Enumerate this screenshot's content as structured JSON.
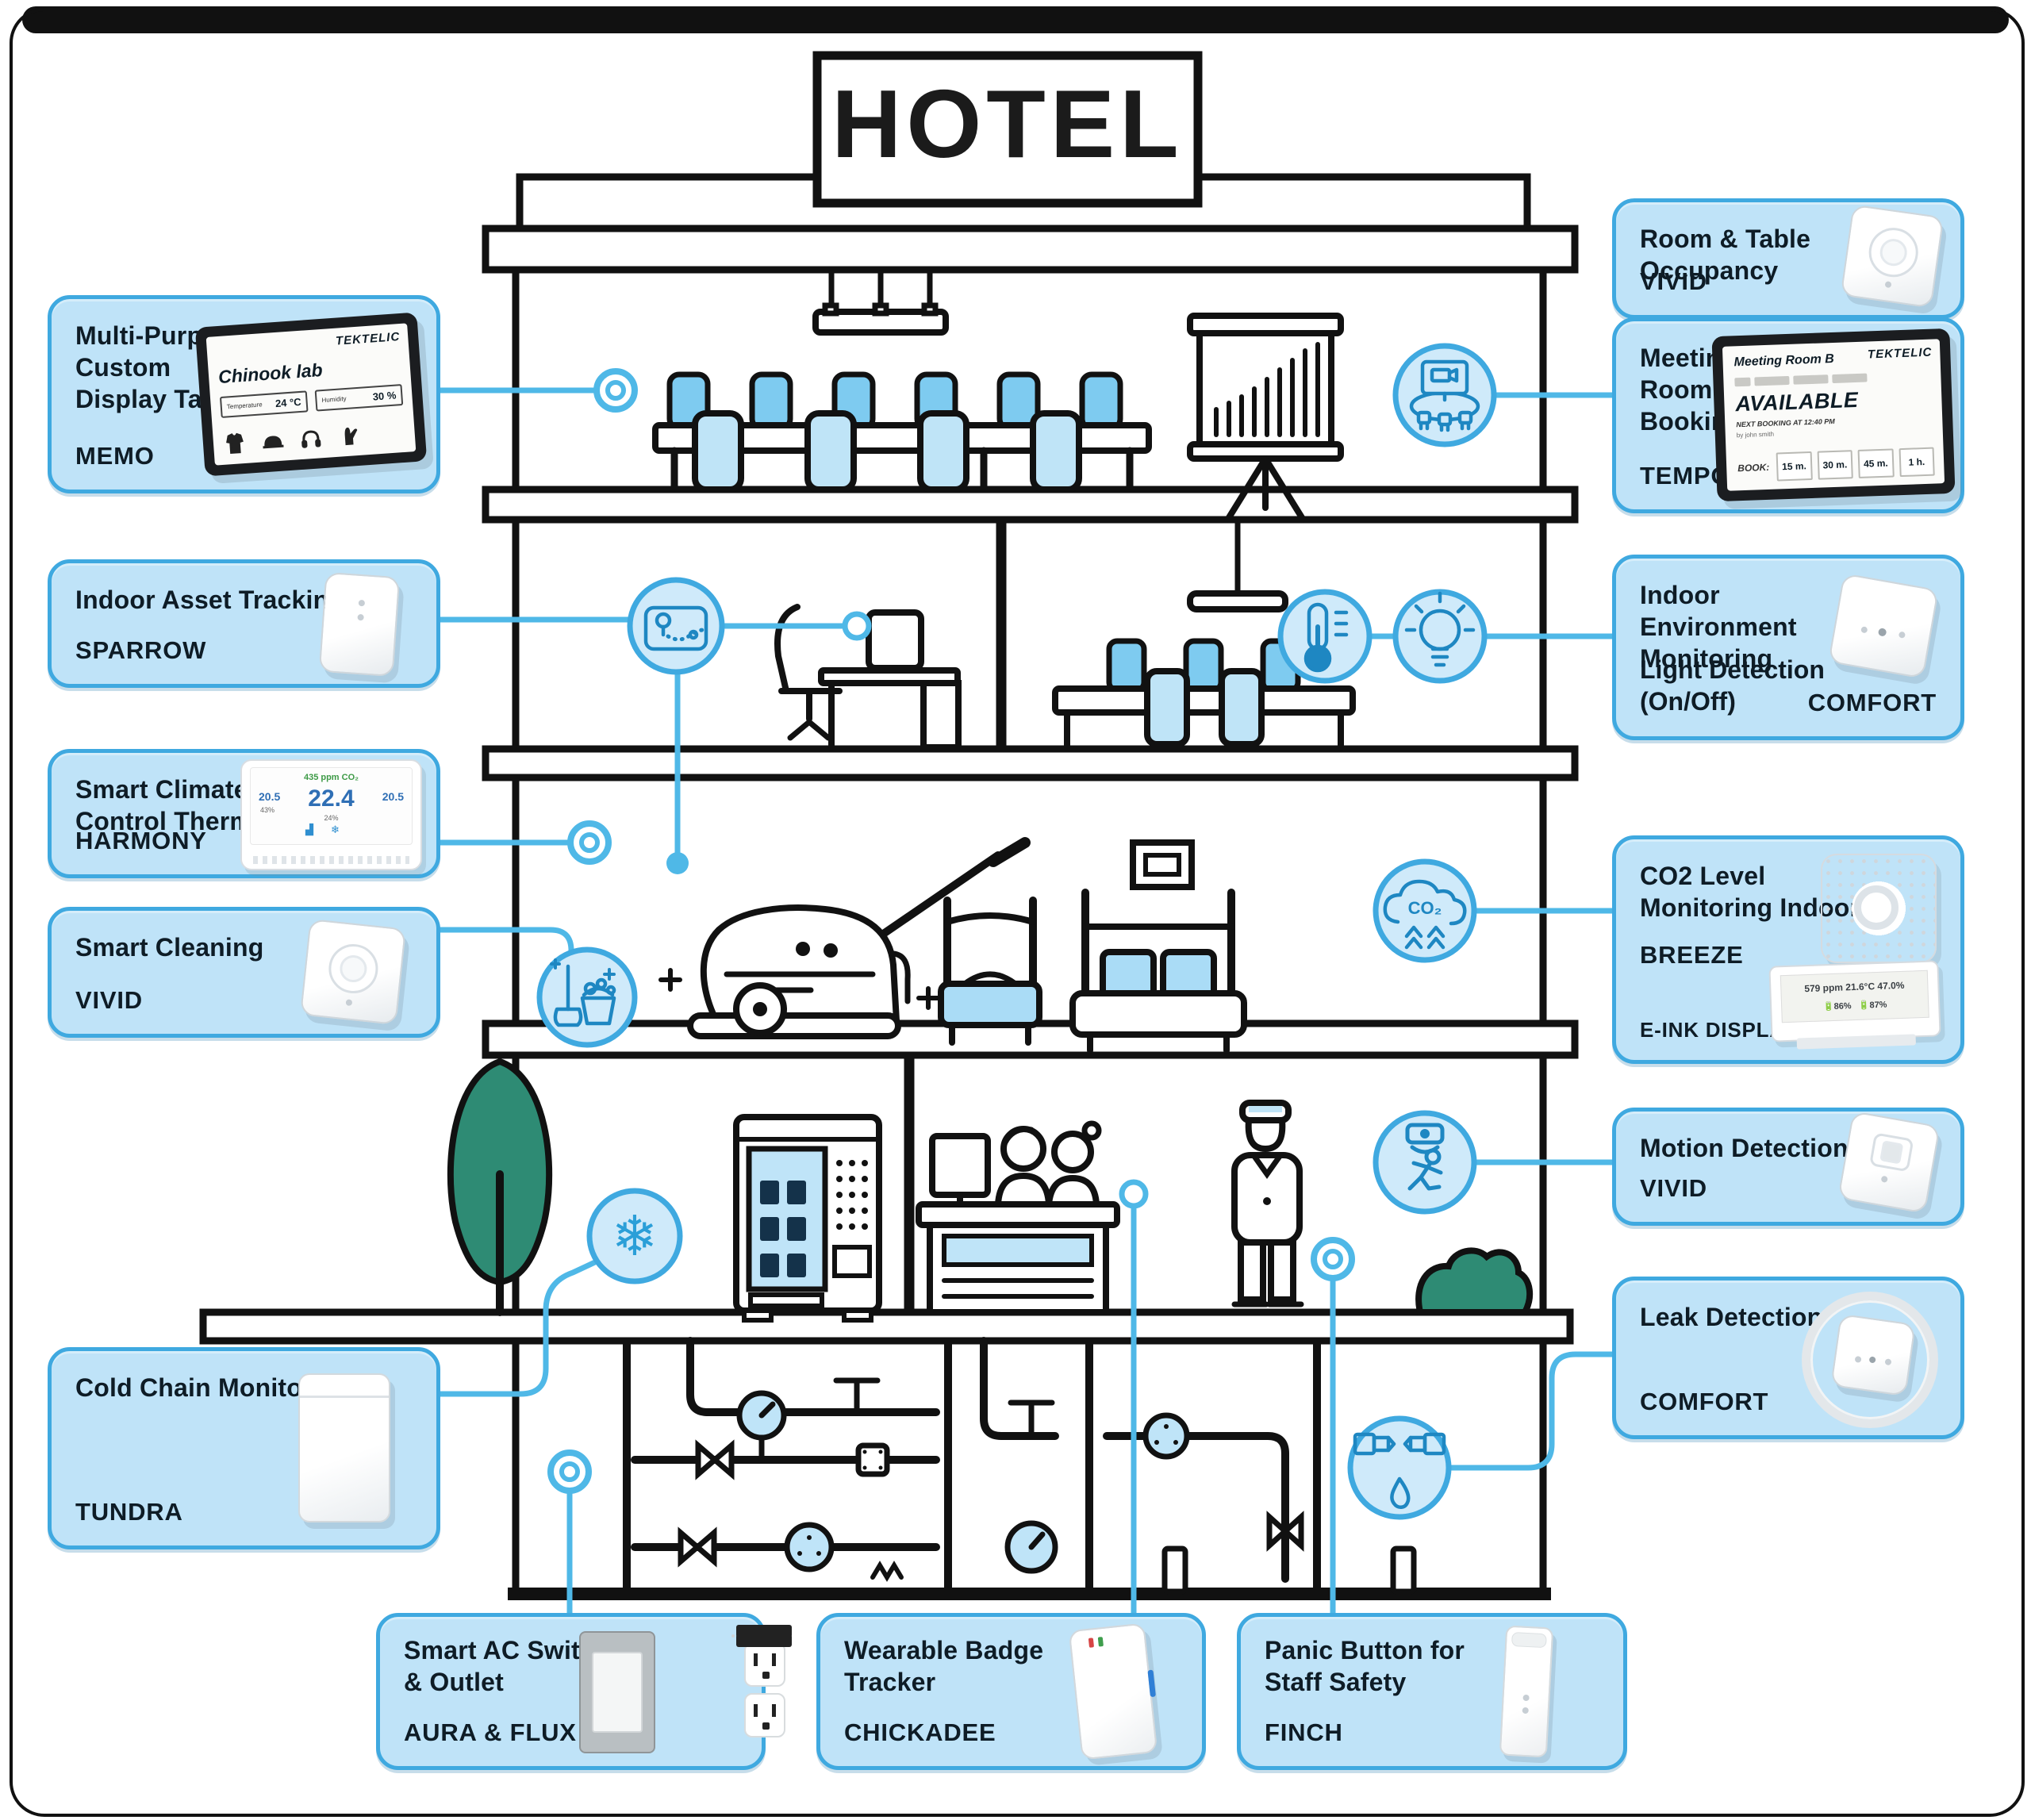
{
  "title": "HOTEL",
  "colors": {
    "accent_line": "#4fb8e7",
    "box_fill": "#bfe3f8",
    "box_border": "#3fa9e0",
    "icon_circle_fill": "#cfeafa",
    "icon_glyph": "#1e87c2",
    "ink": "#111111",
    "text": "#0e1c26",
    "foliage_green": "#2e8b74",
    "chair_blue": "#7ecbf0",
    "chair_light": "#bfe4f7",
    "bed_blue": "#aadcf6"
  },
  "icons": {
    "snowflake_char": "❄",
    "co2_label": "CO₂",
    "hotspots": [
      "meeting-room-icon",
      "asset-tracking-icon",
      "thermometer-icon",
      "lightbulb-icon",
      "cleaning-icon",
      "co2-icon",
      "snowflake-icon",
      "motion-icon",
      "leak-icon"
    ]
  },
  "callouts": {
    "memo": {
      "title": "Multi-Purpose\nCustom\nDisplay Tablet",
      "product": "MEMO",
      "device": {
        "brand": "TEKTELIC",
        "room": "Chinook lab",
        "field1_label": "Temperature",
        "field1_value": "24 °C",
        "field2_label": "Humidity",
        "field2_value": "30 %",
        "icon_names": [
          "safety-vest-icon",
          "hard-hat-icon",
          "ear-protection-icon",
          "gloves-icon"
        ]
      }
    },
    "sparrow": {
      "title": "Indoor Asset Tracking",
      "product": "SPARROW"
    },
    "harmony": {
      "title": "Smart Climate\nControl Thermostat",
      "product": "HARMONY",
      "device": {
        "co2": "435 ppm CO₂",
        "left": "20.5",
        "main": "22.4",
        "right": "20.5",
        "left_sub": "43%",
        "main_sub": "24%",
        "fan_char": "▟",
        "snow_char": "❄"
      }
    },
    "cleaning": {
      "title": "Smart Cleaning",
      "product": "VIVID"
    },
    "tundra": {
      "title": "Cold Chain Monitoring",
      "product": "TUNDRA"
    },
    "occupancy": {
      "title": "Room & Table\nOccupancy",
      "product": "VIVID"
    },
    "tempo": {
      "title": "Meeting\nRoom\nBooking",
      "product": "TEMPO",
      "device": {
        "brand": "TEKTELIC",
        "room": "Meeting Room B",
        "status": "AVAILABLE",
        "next_booking": "NEXT BOOKING AT 12:40 PM",
        "booked_by": "by john smith",
        "book_label": "BOOK:",
        "durations": [
          "15 m.",
          "30 m.",
          "45 m.",
          "1 h."
        ]
      }
    },
    "comfort_env": {
      "title": "Indoor\nEnvironment\nMonitoring",
      "subtitle": "Light Detection\n(On/Off)",
      "product": "COMFORT"
    },
    "breeze": {
      "title": "CO2 Level\nMonitoring Indoor",
      "product": "BREEZE",
      "footer": "E-INK DISPLAY",
      "device": {
        "reading1": "579 ppm  21.6°C  47.0%",
        "batt1": "86%",
        "batt2": "87%"
      }
    },
    "motion": {
      "title": "Motion Detection",
      "product": "VIVID"
    },
    "leak": {
      "title": "Leak Detection",
      "product": "COMFORT"
    },
    "aura": {
      "title": "Smart AC Switch\n& Outlet",
      "product": "AURA & FLUX"
    },
    "chickadee": {
      "title": "Wearable Badge\nTracker",
      "product": "CHICKADEE"
    },
    "finch": {
      "title": "Panic Button for\nStaff Safety",
      "product": "FINCH"
    }
  }
}
